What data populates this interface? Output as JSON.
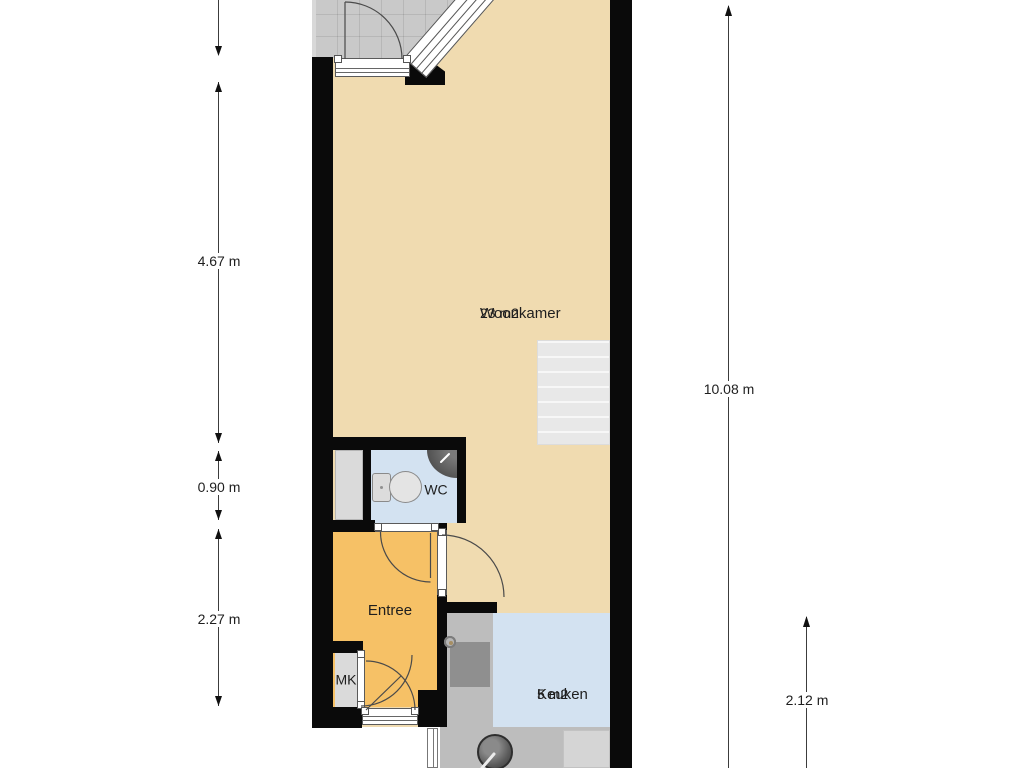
{
  "page": {
    "type": "floor-plan"
  },
  "labels": {
    "woonkamer": {
      "name": "Woonkamer",
      "area": "23 m2"
    },
    "keuken": {
      "name": "Keuken",
      "area": "5 m2"
    },
    "entree": {
      "name": "Entree"
    },
    "wc": {
      "name": "WC"
    },
    "mk": {
      "name": "MK"
    }
  },
  "dimensions": {
    "left_top": "4.67 m",
    "left_middle": "0.90 m",
    "left_bottom": "2.27 m",
    "right_full": "10.08 m",
    "right_bottom": "2.12 m"
  },
  "colors": {
    "wall": "#0a0a0a",
    "woonkamer_floor": "#f0dbb0",
    "entree_floor": "#f6c166",
    "wet_room_floor": "#d3e2f1",
    "balcony": "#c9c9c9",
    "counter": "#bdbdbd",
    "closet": "#dadada",
    "dimension_line": "#3c3c3c",
    "text": "#1e1e1e"
  }
}
